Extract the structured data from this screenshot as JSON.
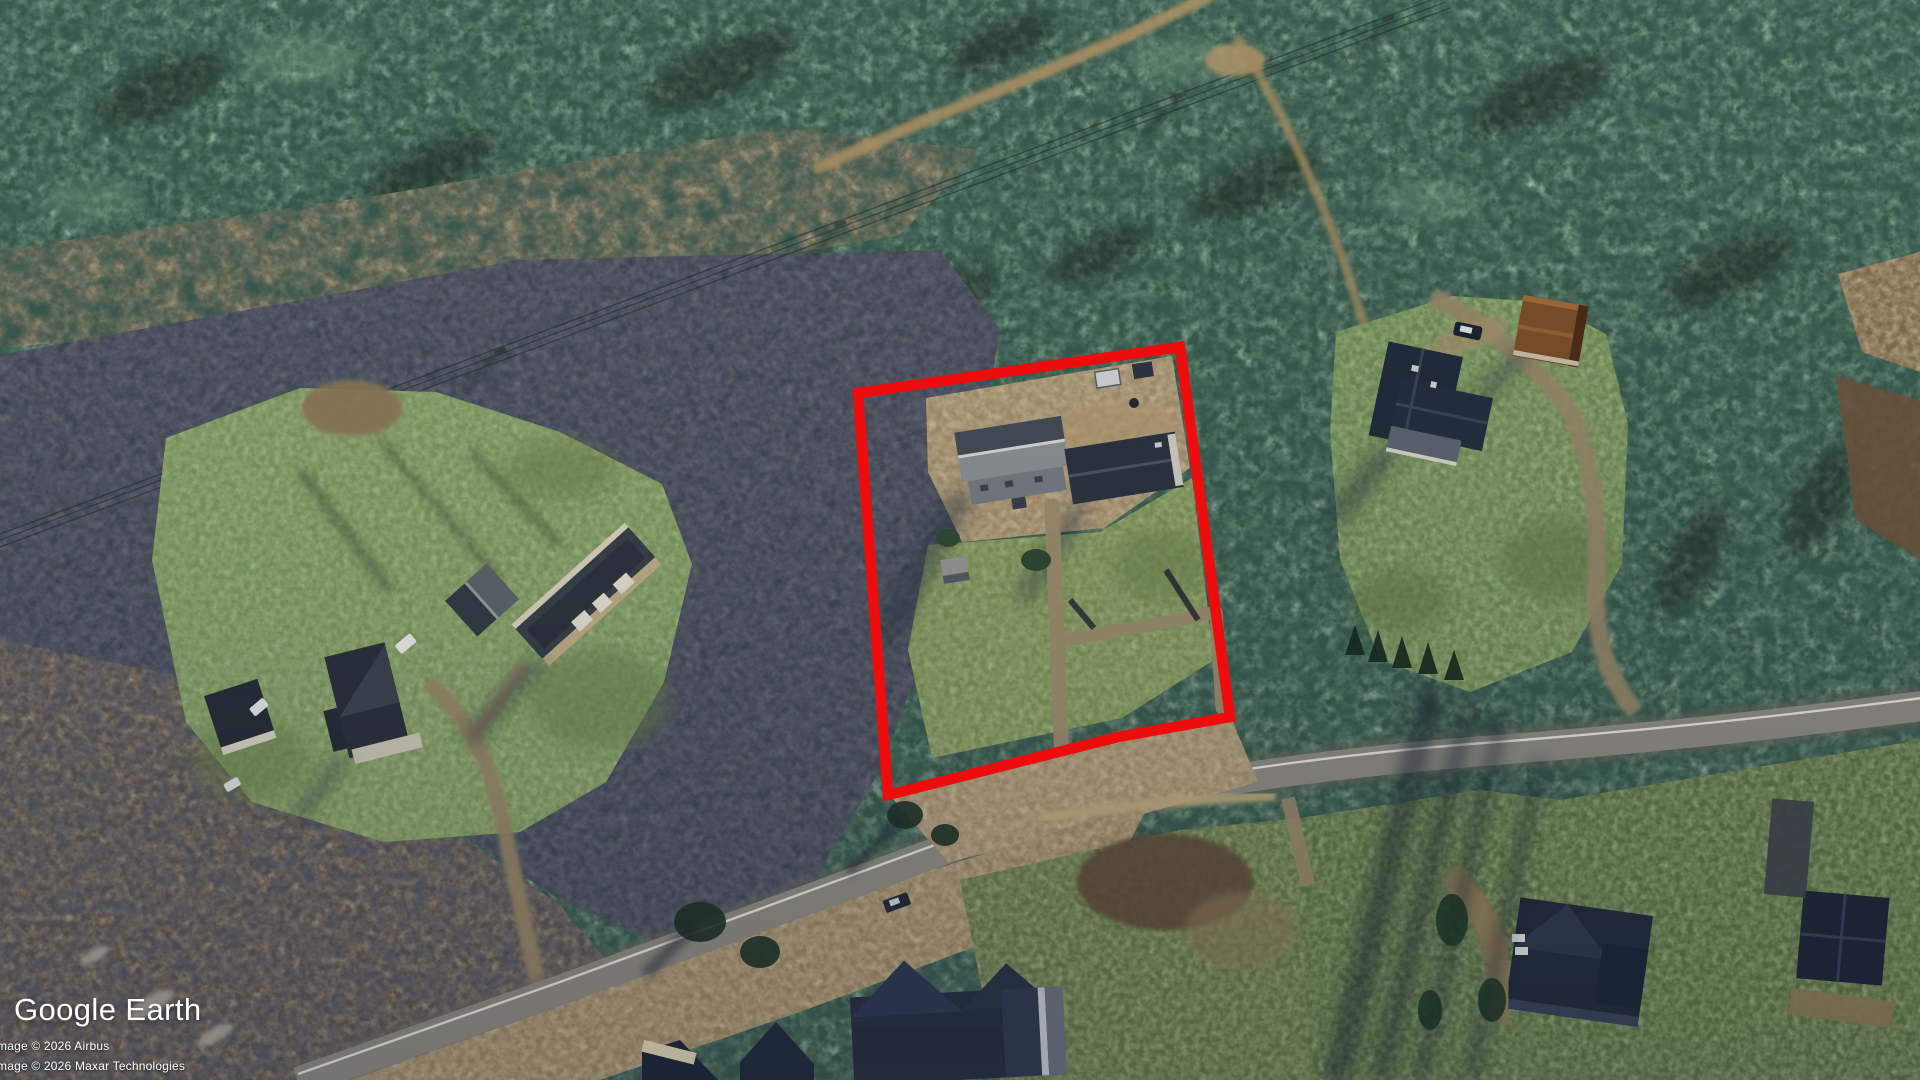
{
  "app": {
    "logo_text": "Google Earth"
  },
  "attribution": {
    "line1": "mage © 2026 Airbus",
    "line2": "mage © 2026 Maxar Technologies"
  },
  "annotation": {
    "label": "highlighted property boundary",
    "points": "858,393 1180,347 1230,717 1118,737 888,795",
    "color": "#ee0c0c",
    "stroke_width": "10.5"
  }
}
